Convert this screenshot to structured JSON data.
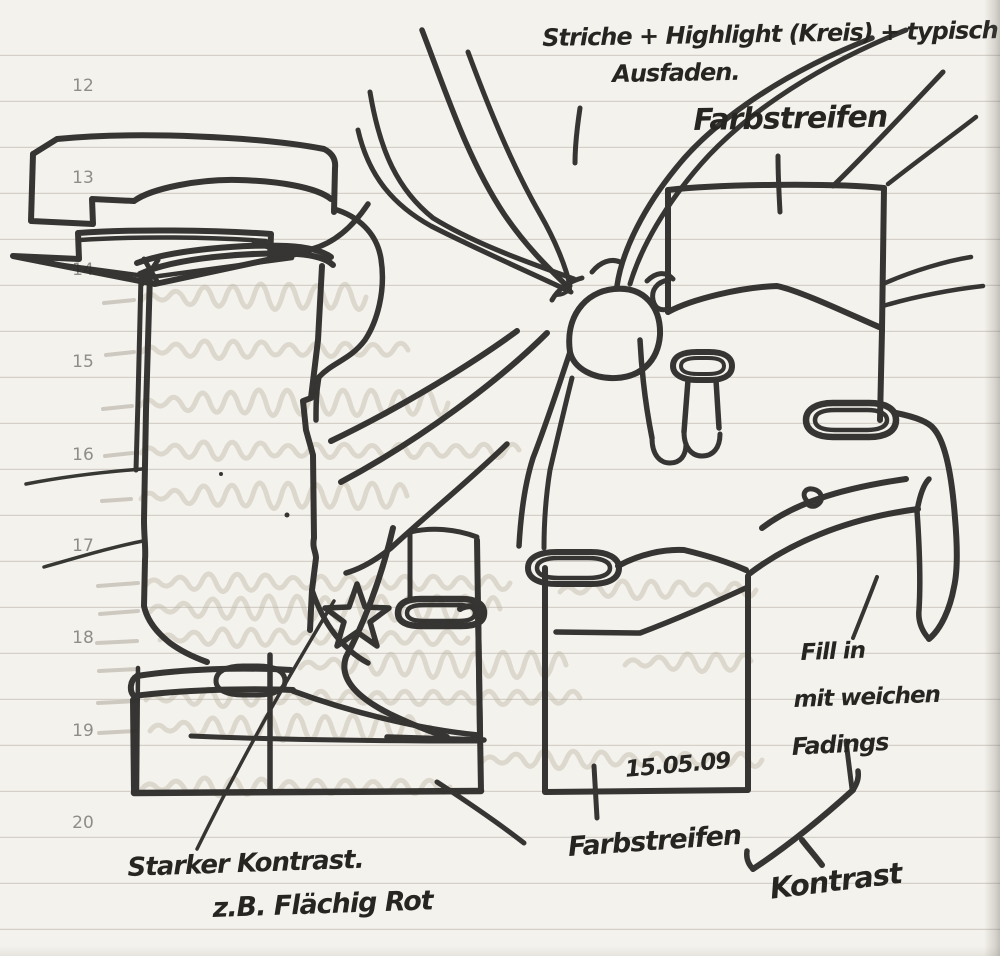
{
  "page": {
    "margin_numbers": [
      "12",
      "13",
      "14",
      "15",
      "16",
      "17",
      "18",
      "19",
      "20"
    ],
    "date": "15.05.09"
  },
  "annotations": {
    "top_note_line1": "Striche + Highlight (Kreis) + typisch",
    "top_note_line2": "Ausfaden.",
    "farbstreifen_top": "Farbstreifen",
    "fill_in_line1": "Fill in",
    "fill_in_line2": "mit weichen",
    "fill_in_line3": "Fadings",
    "farbstreifen_bottom": "Farbstreifen",
    "kontrast": "Kontrast",
    "starker_line1": "Starker Kontrast.",
    "starker_line2": "z.B. Flächig Rot"
  },
  "colors": {
    "ink": "#2b2a28",
    "paper": "#f4f2ec",
    "rule_line": "#cbc8c0",
    "pencil_ghost": "#b9b2a2",
    "margin_number": "#8f8d87"
  }
}
